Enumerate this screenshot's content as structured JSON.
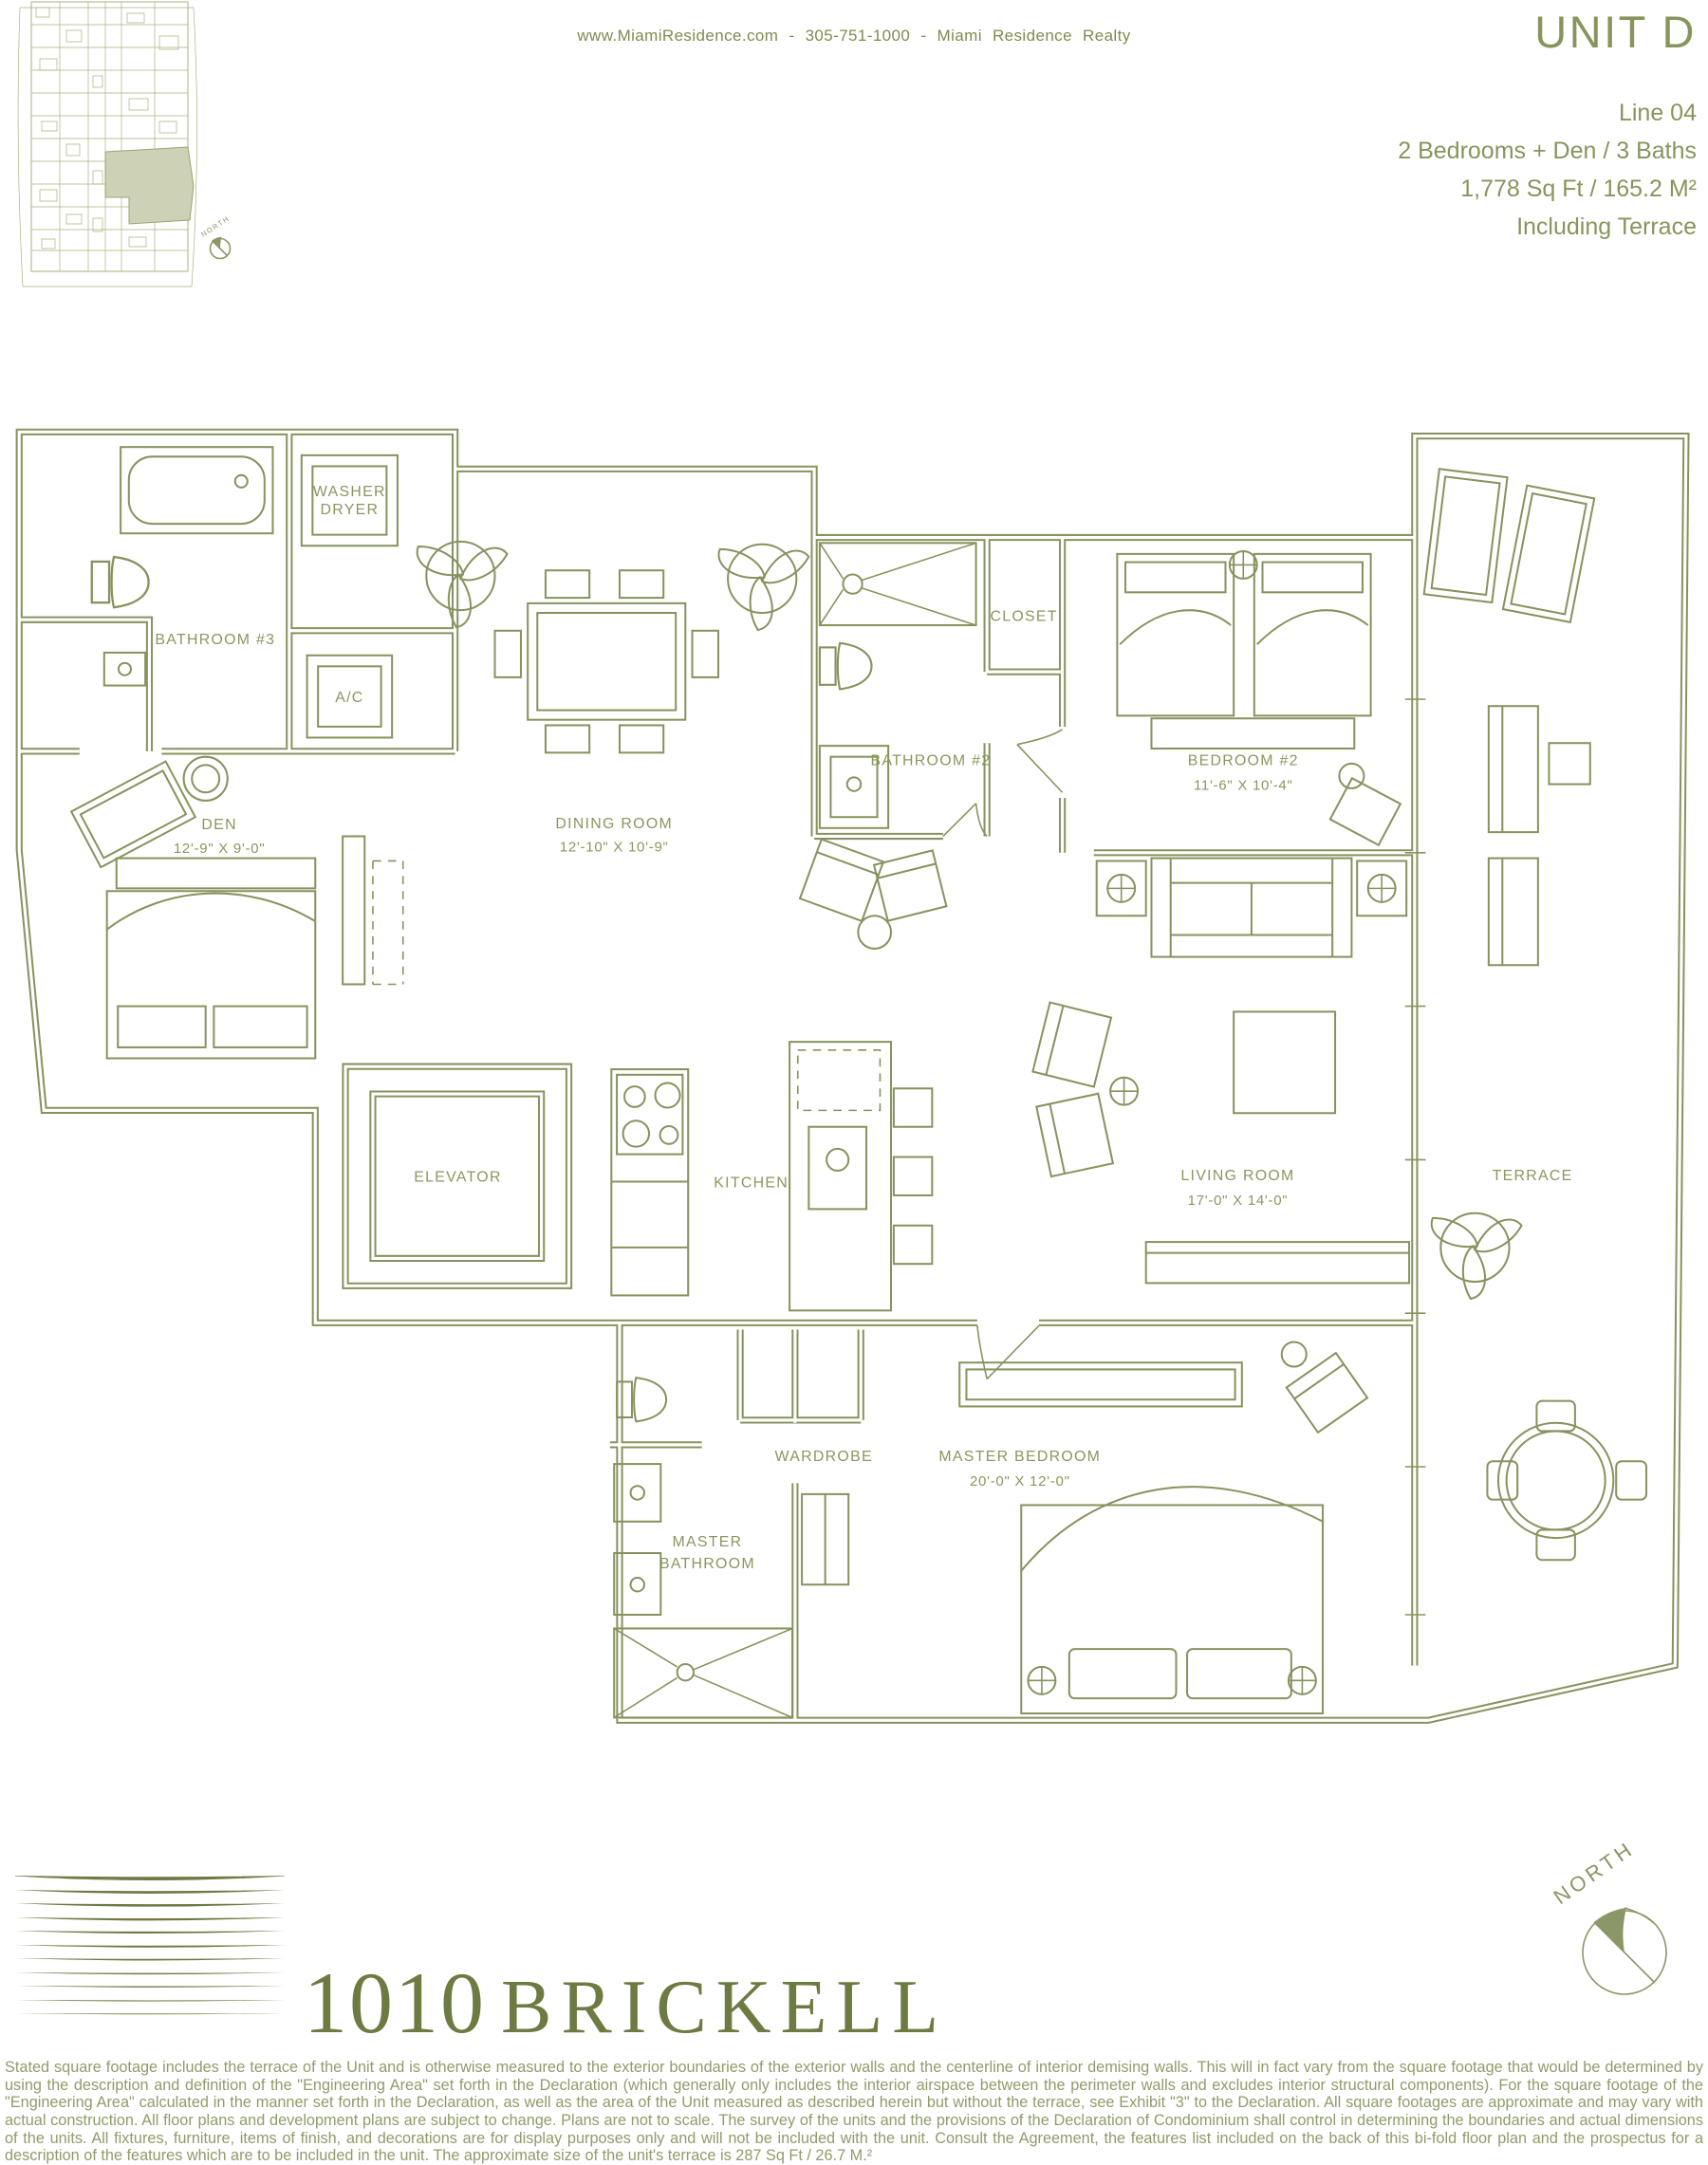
{
  "header": {
    "contact": "www.MiamiResidence.com - 305-751-1000 - Miami Residence Realty",
    "unit_title": "UNIT D",
    "details": [
      "Line 04",
      "2 Bedrooms + Den / 3 Baths",
      "1,778 Sq Ft / 165.2 M²",
      "Including Terrace"
    ]
  },
  "keyplan": {
    "north_label": "NORTH"
  },
  "plan": {
    "washer1": "WASHER",
    "washer2": "DRYER",
    "ac": "A/C",
    "bathroom3": "BATHROOM #3",
    "den": "DEN",
    "den_dims": "12'-9\" X 9'-0\"",
    "dining": "DINING ROOM",
    "dining_dims": "12'-10\" X 10'-9\"",
    "bathroom2": "BATHROOM #2",
    "closet": "CLOSET",
    "bedroom2": "BEDROOM #2",
    "bedroom2_dims": "11'-6\" X 10'-4\"",
    "elevator": "ELEVATOR",
    "kitchen": "KITCHEN",
    "living": "LIVING ROOM",
    "living_dims": "17'-0\" X 14'-0\"",
    "terrace": "TERRACE",
    "wardrobe": "WARDROBE",
    "master_bath1": "MASTER",
    "master_bath2": "BATHROOM",
    "master_bedroom": "MASTER BEDROOM",
    "master_bedroom_dims": "20'-0\" X 12'-0\""
  },
  "footer": {
    "logo_number": "1010",
    "logo_name": "BRICKELL",
    "north_label": "NORTH",
    "disclaimer": "Stated square footage includes the terrace of the Unit and is otherwise measured to the exterior boundaries of the exterior walls and the centerline of interior demising walls. This will in fact vary from the square footage that would be determined by using the description and definition of the \"Engineering Area\" set forth in the Declaration (which generally only includes the interior airspace between the perimeter walls and excludes interior structural components). For the square footage of the \"Engineering Area\" calculated in the manner set forth in the Declaration, as well as the area of the Unit measured as described herein but without the terrace, see Exhibit \"3\" to the Declaration. All square footages are approximate and may vary with actual construction. All floor plans and development plans are subject to change. Plans are not to scale. The survey of the units and the provisions of the Declaration of Condominium shall control in determining the boundaries and actual dimensions of the units. All fixtures, furniture, items of finish, and decorations are for display purposes only and will not be included with the unit. Consult the Agreement, the features list included on the back of this bi-fold floor plan and the prospectus for a description of the features which are to be included in the unit. The approximate size of the unit's terrace is 287 Sq Ft / 26.7 M.²"
  },
  "colors": {
    "olive": "#87935f",
    "olive_dark": "#6d7a42",
    "highlight": "#cdd1b5"
  }
}
